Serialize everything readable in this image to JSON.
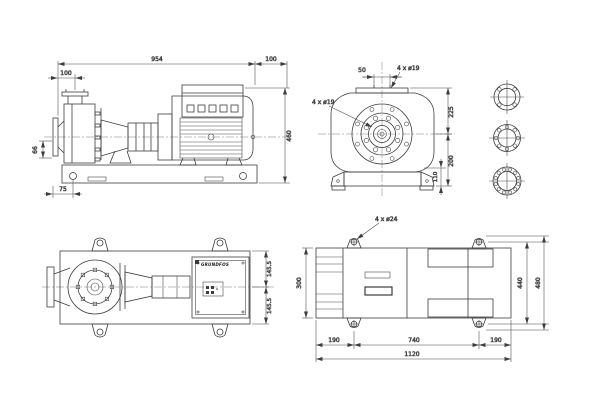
{
  "meta": {
    "colors": {
      "background": "#ffffff",
      "line": "#3d3d3d",
      "text": "#15151d"
    }
  },
  "brand": "GRUNDFOS",
  "views": {
    "side_elevation": {
      "dims": {
        "overall_length": "954",
        "rear_length": "100",
        "port_to_face": "100",
        "overall_height": "460",
        "suction_drop": "66",
        "face_to_foot": "75"
      }
    },
    "end_view": {
      "dims": {
        "port_offset": "50",
        "top_flange_holes": "4 x ø19",
        "suction_flange_holes": "4 x ø19",
        "center_to_top": "225",
        "center_to_base": "200",
        "foot_height": "110"
      }
    },
    "plan_pump": {
      "dims": {
        "center_to_edge_top": "145.5",
        "center_to_edge_bottom": "145.5"
      }
    },
    "plan_baseplate": {
      "dims": {
        "anchor_holes": "4 x ø24",
        "plate_width": "300",
        "hole_span_width": "440",
        "overall_width": "480",
        "end_margin_left": "190",
        "hole_span_length": "740",
        "end_margin_right": "190",
        "overall_length": "1120"
      }
    }
  }
}
